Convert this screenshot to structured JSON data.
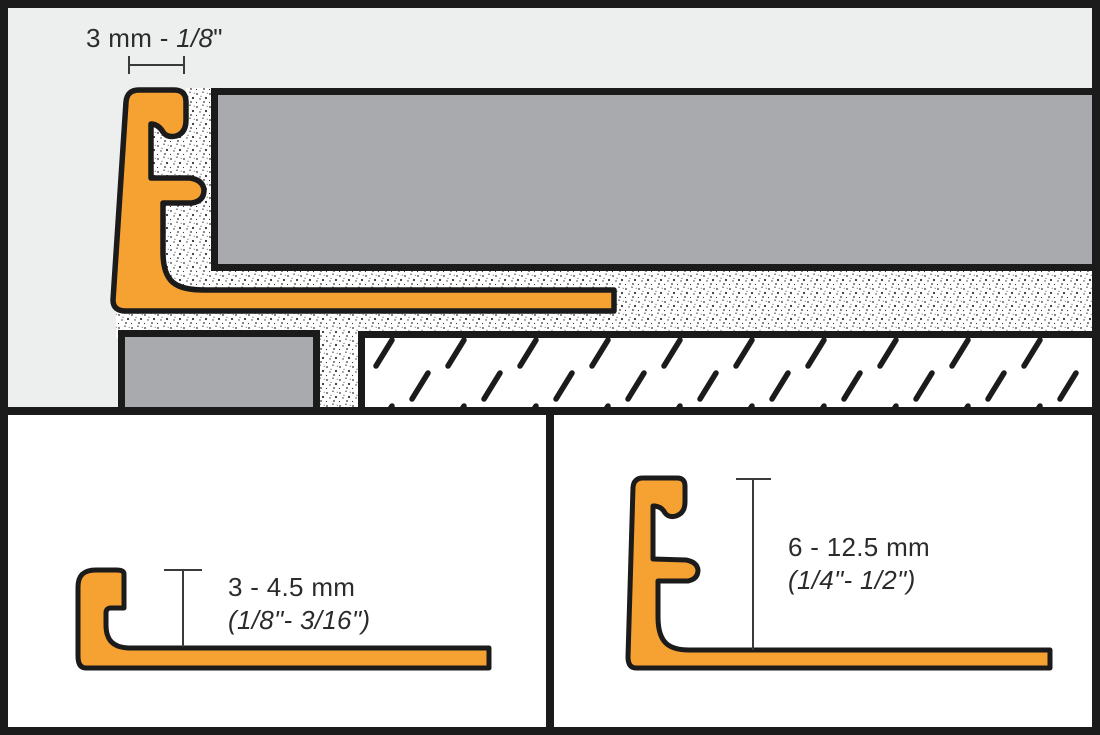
{
  "top_panel": {
    "description_name": "profile-joint-width-dimension",
    "dimension_label": {
      "text_regular": "3 mm - ",
      "text_italic": "1/8",
      "unit_mark": "\""
    }
  },
  "bottom_left_panel": {
    "description_name": "low-profile-height-dimension",
    "height_mm": "3 - 4.5 mm",
    "height_inches": "(1/8\"- 3/16\")"
  },
  "bottom_right_panel": {
    "description_name": "high-profile-height-dimension",
    "height_mm": "6 - 12.5 mm",
    "height_inches": "(1/4\"- 1/2\")"
  },
  "colors": {
    "profile_orange": "#F5A232",
    "tile_gray": "#A8AAAD",
    "panel_background_gray": "#EDEEEE",
    "panel_background_white": "#FFFFFF",
    "outline_black": "#1B1B1B",
    "dimension_line_gray": "#3A3A3A",
    "text_color": "#2B2B2B"
  }
}
